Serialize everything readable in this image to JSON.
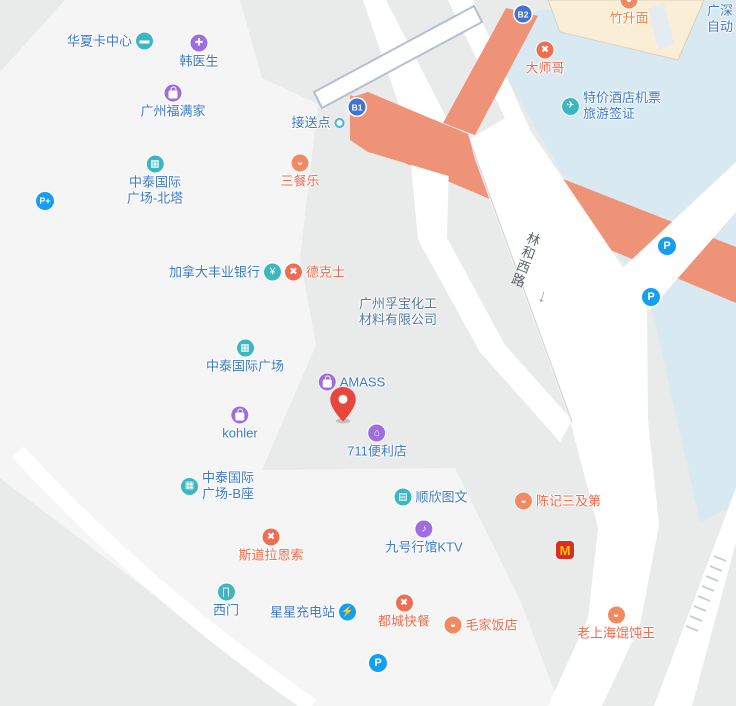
{
  "palette": {
    "background_gray": "#e9eaea",
    "block_light": "#f5f5f6",
    "block_blue": "#d9e9f2",
    "block_cream": "#faeed6",
    "walkway_salmon": "#ef9378",
    "road_white": "#ffffff",
    "overpass_stroke": "#b4bfcf",
    "poi_text_blue": "#3c78c8",
    "poi_text_orange": "#f2684a",
    "company_text_slate": "#55789d",
    "icon_teal": "#3cb6c0",
    "icon_purple": "#9e6ede",
    "icon_bowl_orange": "#f08a62",
    "icon_cutlery_red": "#ef6e52",
    "parking_blue": "#149ff0",
    "exit_badge_navy": "#4273cf",
    "mcdonalds_red": "#dd2c24",
    "mcdonalds_gold": "#ffc600",
    "pin_red": "#e8463c"
  },
  "glyphs": {
    "card": "▬",
    "doctor": "✚",
    "building": "▦",
    "yen": "¥",
    "cutlery": "✖",
    "bowl": "◒",
    "store": "⌂",
    "printer": "▤",
    "mic": "♪",
    "gate": "∏",
    "charger": "⚡",
    "ticket": "✈",
    "parking": "P",
    "parking_plus": "P+",
    "exit_b1": "B1",
    "exit_b2": "B2",
    "mcdonalds": "M",
    "arrow_down": "↓"
  },
  "road": {
    "name": "林和西路"
  },
  "corner_note": {
    "line1": "广深",
    "line2": "自动"
  },
  "pois": {
    "huaxia": {
      "name": "华夏卡中心"
    },
    "hanyisheng": {
      "name": "韩医生"
    },
    "fumanjia": {
      "name": "广州福满家"
    },
    "beita": {
      "line1": "中泰国际",
      "line2": "广场-北塔"
    },
    "jiesongdian": {
      "name": "接送点"
    },
    "sancanle": {
      "name": "三餐乐"
    },
    "dashige": {
      "name": "大师哥"
    },
    "zhushengmian": {
      "name": "竹升面"
    },
    "tejia": {
      "line1": "特价酒店机票",
      "line2": "旅游签证"
    },
    "bank": {
      "name": "加拿大丰业银行"
    },
    "dekeshi": {
      "name": "德克士"
    },
    "fubao": {
      "line1": "广州孚宝化工",
      "line2": "材料有限公司"
    },
    "zhongtai": {
      "name": "中泰国际广场"
    },
    "amass": {
      "name": "AMASS"
    },
    "kohler": {
      "name": "kohler"
    },
    "seven_eleven": {
      "name": "711便利店"
    },
    "bzuo": {
      "line1": "中泰国际",
      "line2": "广场-B座"
    },
    "shunxin": {
      "name": "顺欣图文"
    },
    "chenji": {
      "name": "陈记三及第"
    },
    "sidaolaensuo": {
      "name": "斯道拉恩索"
    },
    "ktv": {
      "name": "九号行馆KTV"
    },
    "ximen": {
      "name": "西门"
    },
    "xingxing": {
      "name": "星星充电站"
    },
    "ducheng": {
      "name": "都城快餐"
    },
    "maojia": {
      "name": "毛家饭店"
    },
    "laoshanghai": {
      "name": "老上海馄饨王"
    }
  }
}
